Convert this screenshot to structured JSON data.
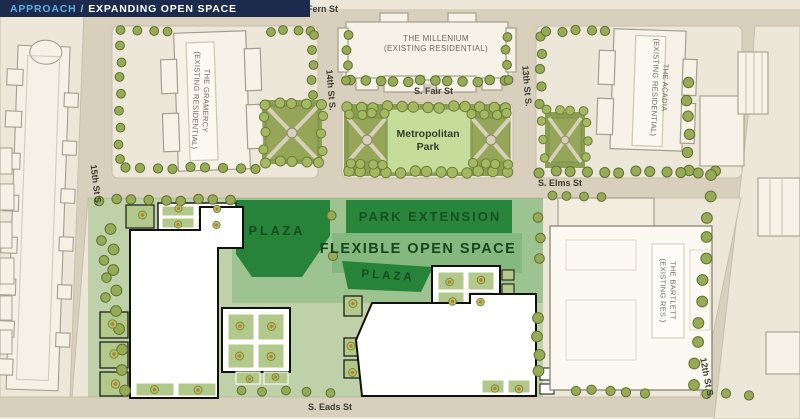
{
  "header": {
    "approach_label": "APPROACH",
    "separator": "/",
    "title": "EXPANDING OPEN SPACE"
  },
  "streets": {
    "fern": "S. Fern St",
    "fair": "S. Fair St",
    "elms": "S. Elms St",
    "eads": "S. Eads St",
    "st_15": "15th St S.",
    "st_14": "14th St S.",
    "st_13": "13th St S.",
    "st_12": "12th St S."
  },
  "buildings": {
    "gramercy_line1": "THE GRAMERCY",
    "gramercy_line2": "(EXISTING RESIDENTIAL)",
    "millenium_line1": "THE MILLENIUM",
    "millenium_line2": "(EXISTING RESIDENTIAL)",
    "acadia_line1": "THE ACADIA",
    "acadia_line2": "(EXISTING RESIDENTIAL)",
    "bartlett_line1": "THE BARTLETT",
    "bartlett_line2": "(EXISTING RES.)"
  },
  "open_space": {
    "metropolitan_line1": "Metropolitan",
    "metropolitan_line2": "Park",
    "park_extension": "PARK EXTENSION",
    "flexible_open_space": "FLEXIBLE OPEN SPACE",
    "plaza_north": "PLAZA",
    "plaza_south": "PLAZA"
  },
  "colors": {
    "header_bg": "#1c2b4d",
    "header_accent": "#62aede",
    "header_text": "#ffffff",
    "street": "#d8d0bc",
    "block": "#ece7d9",
    "building_existing": "#f6f2e7",
    "building_new": "#ffffff",
    "park_green": "#c6dc9b",
    "planting_green": "#8a9e54",
    "open_space_wash": "#8fbc79",
    "plaza_dark_green": "#1e7e33",
    "tree_green": "#97ab56",
    "label_dark": "#3c3a33"
  }
}
